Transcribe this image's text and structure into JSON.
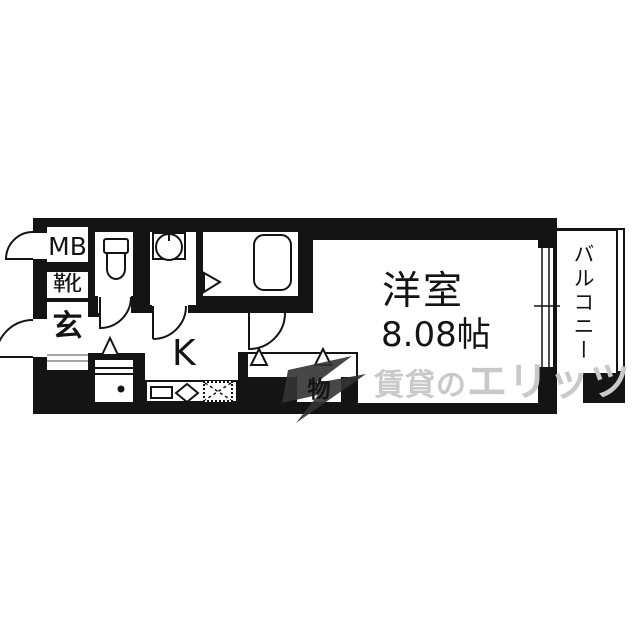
{
  "floorplan": {
    "rooms": {
      "western_room": {
        "name": "洋室",
        "size": "8.08帖"
      },
      "kitchen": {
        "label": "K"
      },
      "balcony": {
        "label": "バルコニー"
      },
      "entrance": {
        "label": "玄"
      },
      "shoe_cabinet": {
        "label": "靴"
      },
      "meter_box": {
        "label": "MB"
      },
      "storage": {
        "label": "物"
      }
    },
    "fixtures": {
      "toilet": "toilet-icon",
      "washing_machine": "washing-machine-pan-icon",
      "bathtub": "bathtub-icon",
      "kitchen_sink": "kitchen-sink-icon",
      "burner": "burner-diamond-icon",
      "stove_space": "stove-space-hatched-icon",
      "refrigerator": "refrigerator-icon",
      "doors": "quarter-arc-door-icons",
      "folding_door_markers": "triangle-markers",
      "window": "sliding-window-icon"
    },
    "colors": {
      "wall": "#141414",
      "floor": "#ffffff",
      "watermark_text": "#c9c9c9",
      "watermark_logo": "#333333"
    }
  },
  "watermark": {
    "brand_prefix": "賃貸の",
    "brand_name": "エリッツ"
  }
}
